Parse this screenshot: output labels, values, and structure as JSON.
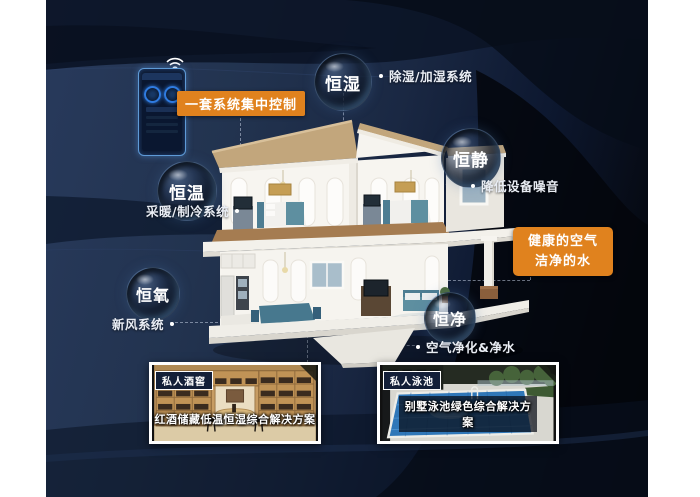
{
  "control": {
    "label": "一套系统集中控制"
  },
  "bubbles": [
    {
      "label": "恒湿",
      "note": "除湿/加湿系统"
    },
    {
      "label": "恒静",
      "note": "降低设备噪音"
    },
    {
      "label": "恒温",
      "note": "采暖/制冷系统"
    },
    {
      "label": "恒氧",
      "note": "新风系统"
    },
    {
      "label": "恒净",
      "note": "空气净化&净水"
    }
  ],
  "callout": {
    "line1": "健康的空气",
    "line2": "洁净的水"
  },
  "cards": [
    {
      "tag": "私人酒窖",
      "caption": "红酒储藏低温恒湿综合解决方案"
    },
    {
      "tag": "私人泳池",
      "caption": "别墅泳池绿色综合解决方案"
    }
  ],
  "colors": {
    "accent": "#E0821E",
    "background": "#1C2B4A",
    "text": "#FFFFFF",
    "note_text": "#E9EDF4"
  }
}
